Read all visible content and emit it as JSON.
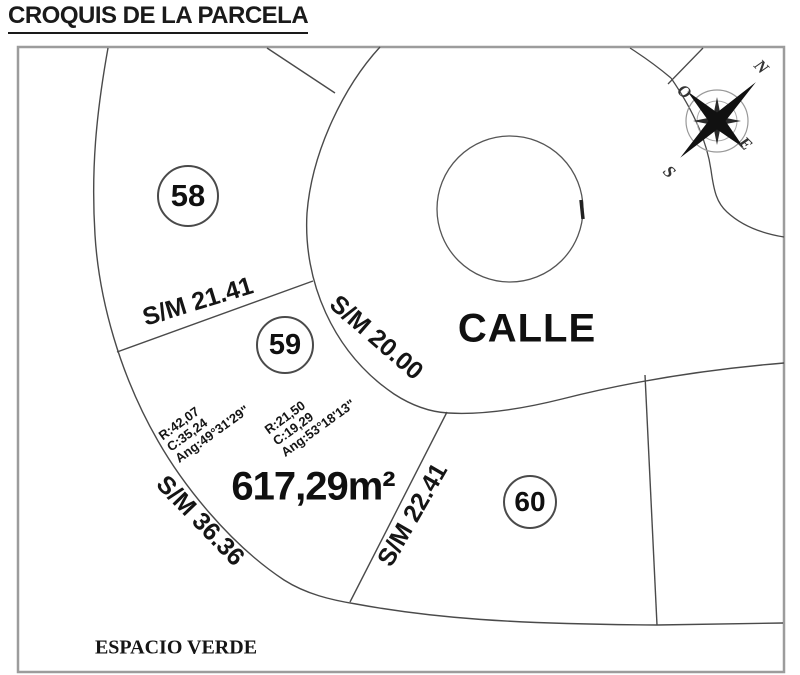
{
  "title": "CROQUIS DE LA PARCELA",
  "diagram": {
    "street_label": "CALLE",
    "green_space_label": "ESPACIO VERDE",
    "parcels": [
      {
        "id": "58"
      },
      {
        "id": "59"
      },
      {
        "id": "60"
      }
    ],
    "main_parcel": {
      "number": "59",
      "area": "617,29m²",
      "sides": [
        {
          "label": "S/M 21.41"
        },
        {
          "label": "S/M 20.00"
        },
        {
          "label": "S/M 22.41"
        },
        {
          "label": "S/M 36.36"
        }
      ],
      "curves": [
        {
          "radius": "R:42,07",
          "chord": "C:35,24",
          "angle": "Ang:49°31'29\""
        },
        {
          "radius": "R:21,50",
          "chord": "C:19,29",
          "angle": "Ang:53°18'13\""
        }
      ]
    },
    "compass": {
      "north": "N",
      "south": "S",
      "east": "E",
      "west": "O"
    }
  },
  "colors": {
    "line": "#4a4a4a",
    "frame": "#9c9c9c",
    "text": "#111111",
    "background": "#ffffff"
  }
}
